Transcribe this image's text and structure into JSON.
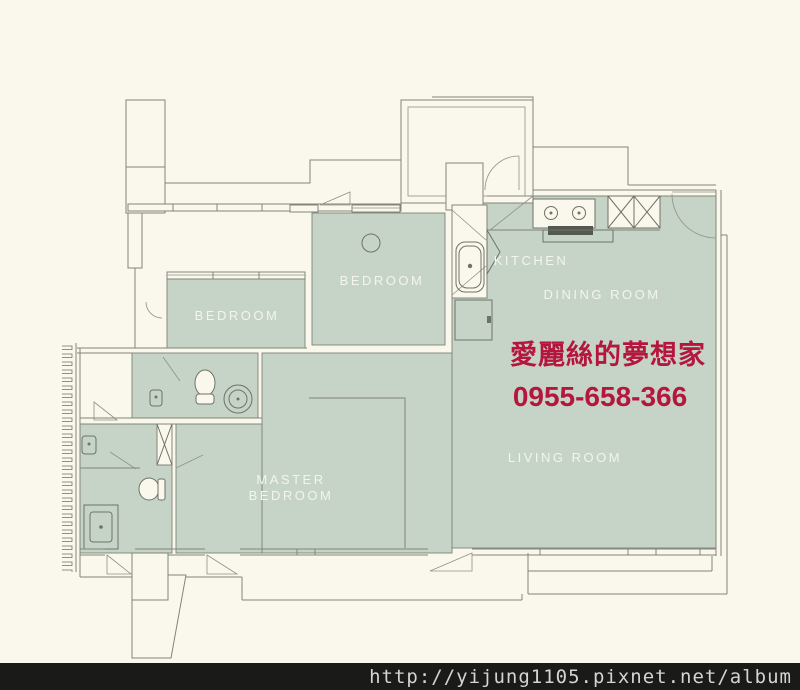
{
  "colors": {
    "background": "#faf7ec",
    "room_fill": "#c6d4c7",
    "wall_line": "#82857a",
    "room_label_text": "#f3f5ec",
    "watermark_red": "#b5163e",
    "footer_bg": "#1a1a18",
    "footer_text": "#d4d4d2"
  },
  "plan": {
    "type": "apartment-floor-plan",
    "rooms": [
      {
        "id": "bedroom-left",
        "label": "BEDROOM"
      },
      {
        "id": "bedroom-middle",
        "label": "BEDROOM"
      },
      {
        "id": "kitchen",
        "label": "KITCHEN"
      },
      {
        "id": "dining-room",
        "label": "DINING ROOM"
      },
      {
        "id": "living-room",
        "label": "LIVING ROOM"
      },
      {
        "id": "master-bedroom",
        "label_line1": "MASTER",
        "label_line2": "BEDROOM"
      }
    ],
    "fixtures": [
      "stove-icon",
      "range-hood-grill-icon",
      "pantry-x-cabinet-icon",
      "kitchen-sink-icon",
      "kitchen-cabinet-icon",
      "toilet-icon",
      "round-tub-icon",
      "pedestal-sink-icon",
      "wall-sink-icon",
      "vanity-sink-icon",
      "entry-door-arc-icon",
      "foyer-door-arc-icon",
      "door-swing-icon",
      "window-band-icon",
      "louver-trellis-icon",
      "ceiling-light-icon",
      "chimney-shaft-icon",
      "closet-x-icon"
    ]
  },
  "watermark": {
    "title": "愛麗絲的夢想家",
    "phone": "0955-658-366"
  },
  "footer": {
    "url": "http://yijung1105.pixnet.net/album"
  }
}
